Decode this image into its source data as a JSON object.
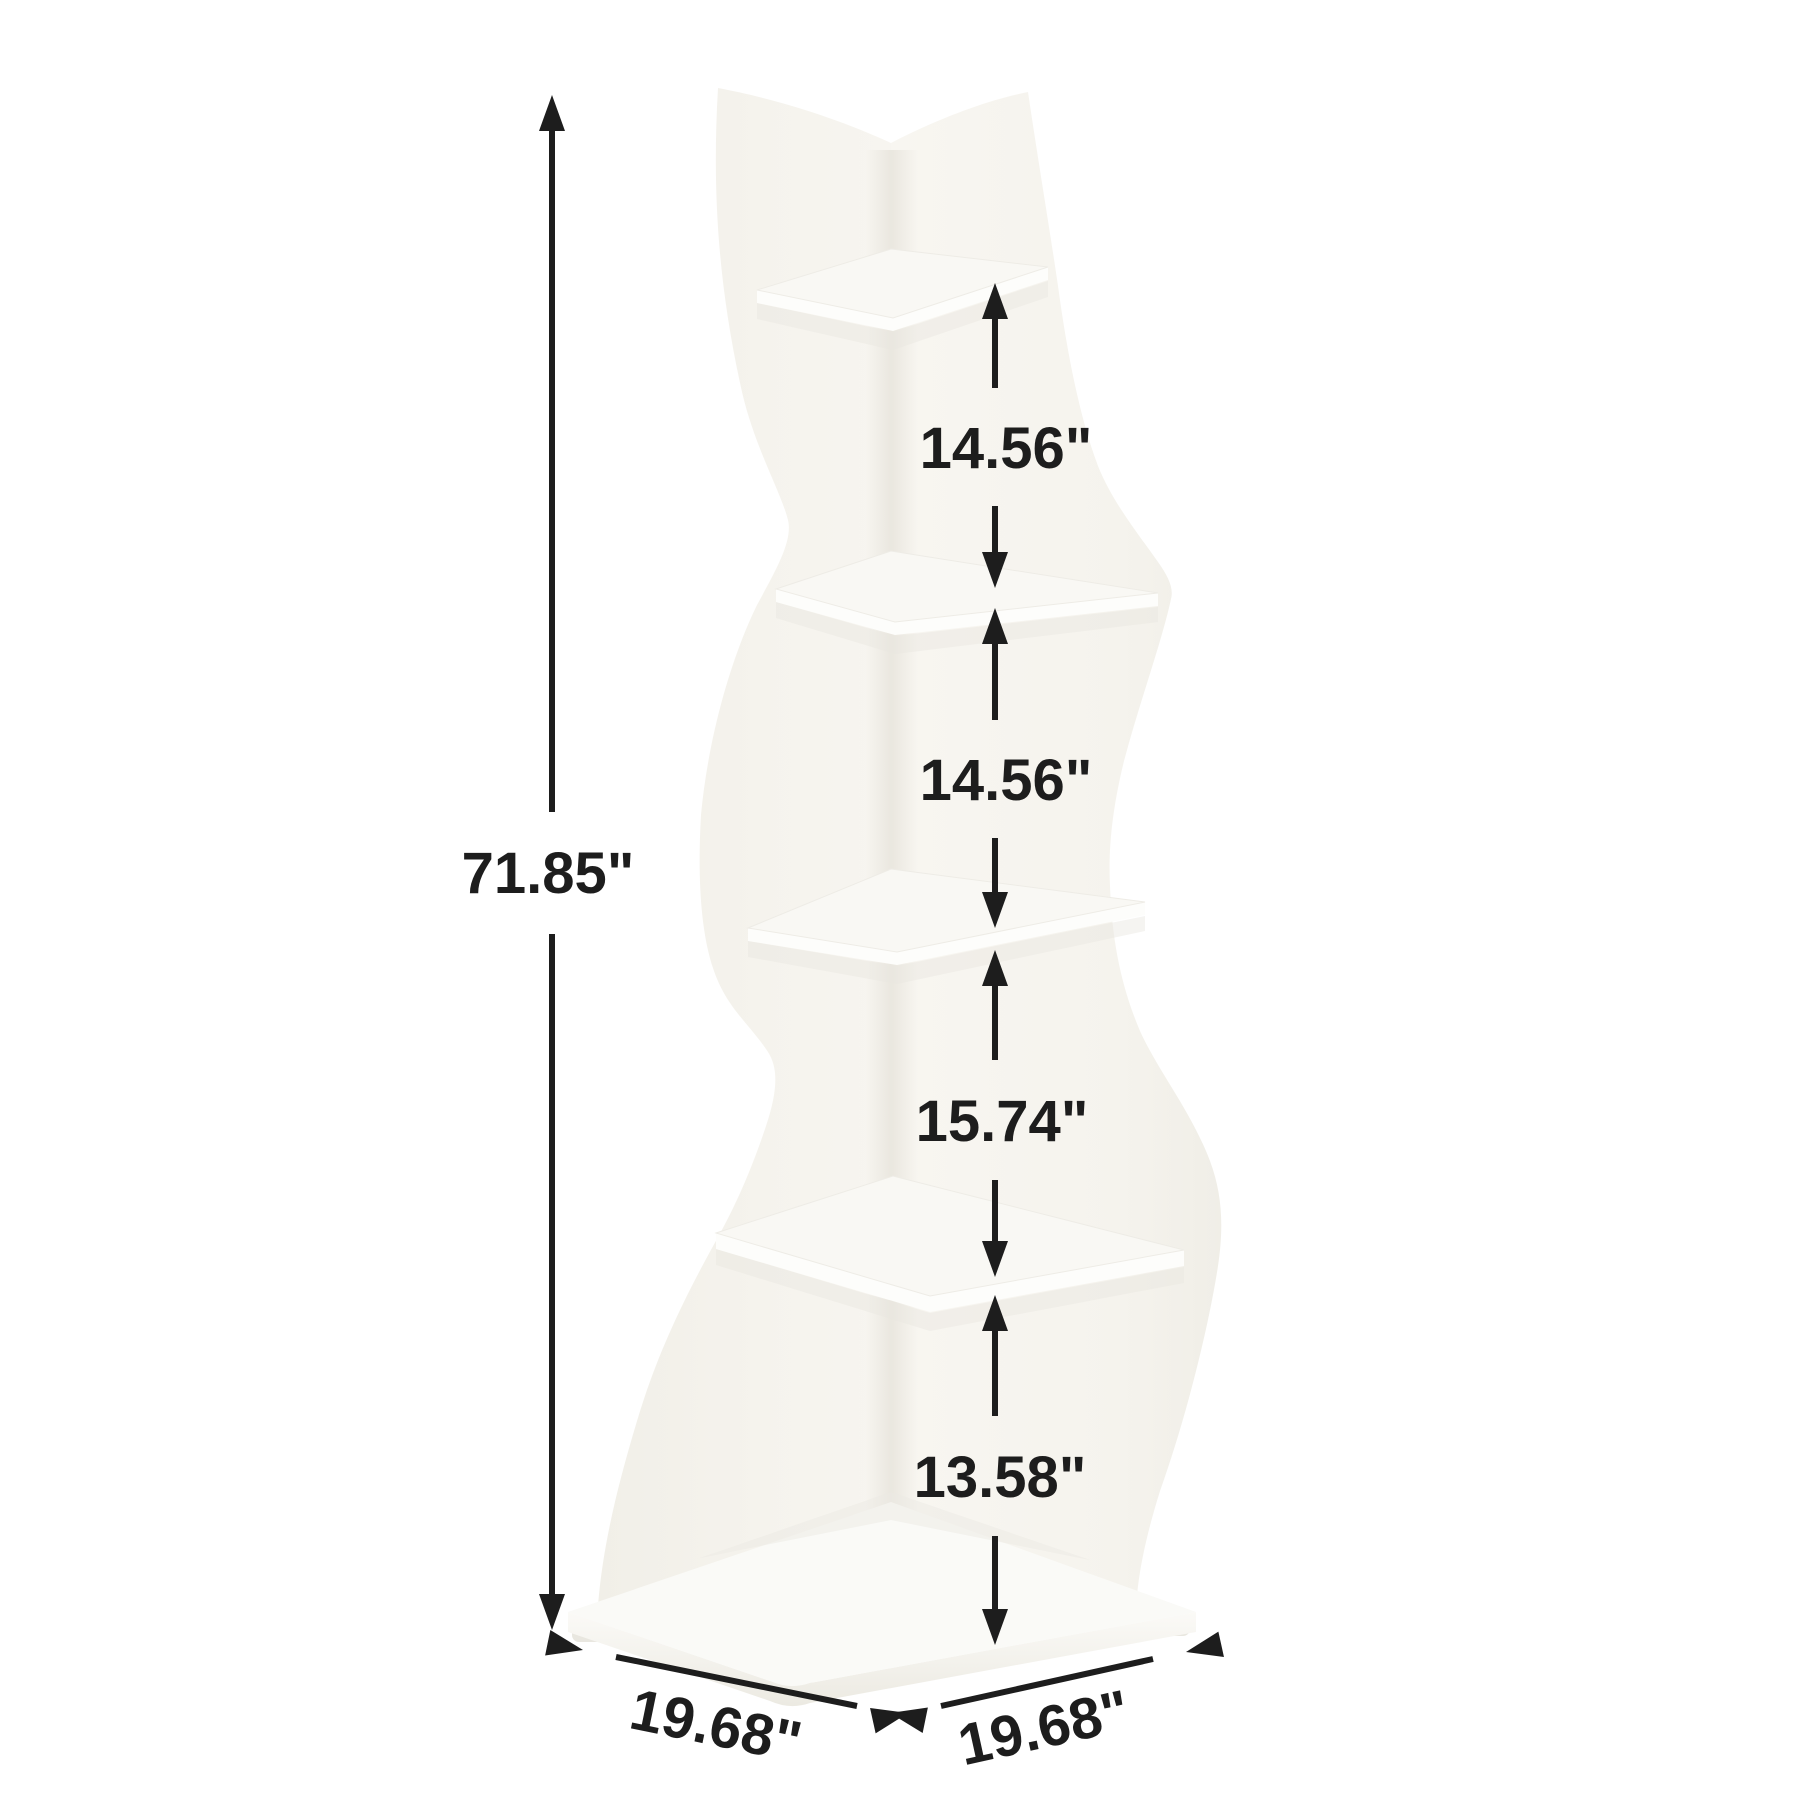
{
  "figure": {
    "kind": "product-dimension-diagram",
    "subject": "wavy-5-tier-corner-shelf",
    "background_color": "#ffffff",
    "annotation_color": "#1d1d1d",
    "body_color": "#f5f3ee",
    "shelf_edge_color": "#fdfdfb",
    "shadow_color": "#e8e6df"
  },
  "dimensions": {
    "total_height": "71.85\"",
    "tier_gaps": [
      {
        "label": "14.56\""
      },
      {
        "label": "14.56\""
      },
      {
        "label": "15.74\""
      },
      {
        "label": "13.58\""
      }
    ],
    "base_left": "19.68\"",
    "base_right": "19.68\""
  }
}
